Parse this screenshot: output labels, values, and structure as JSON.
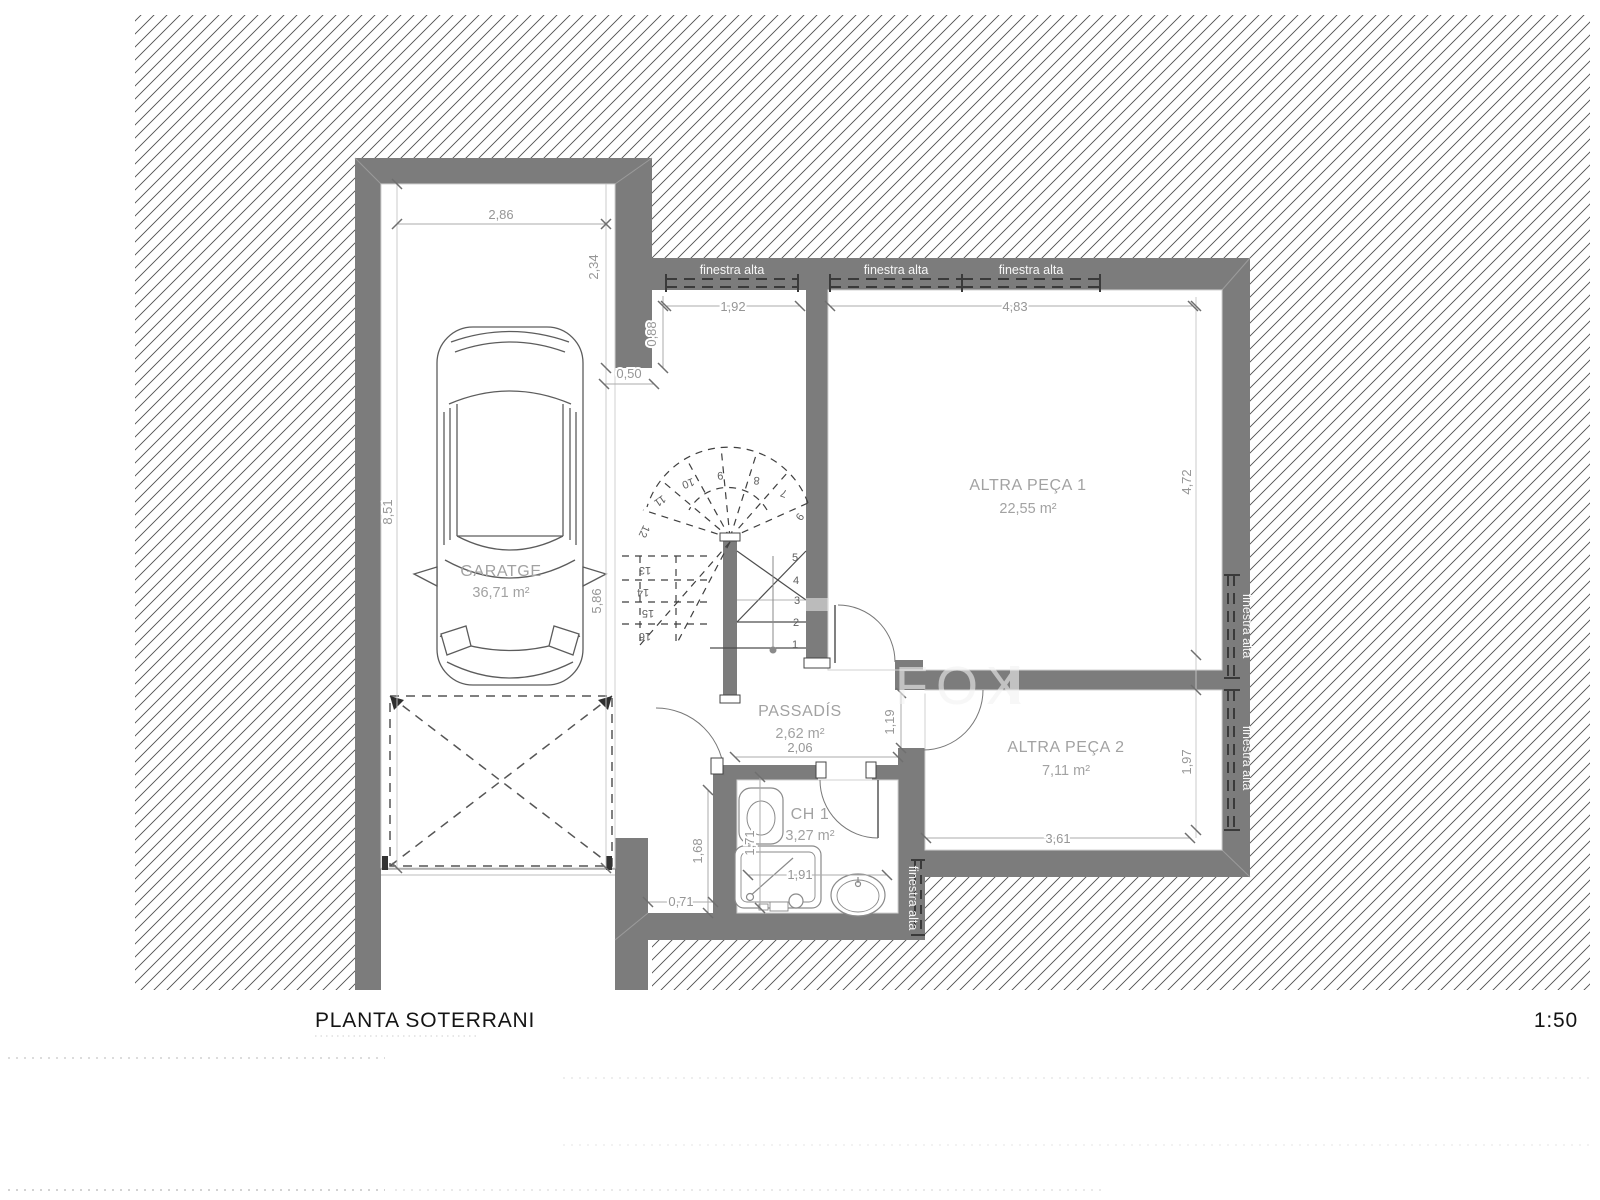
{
  "document": {
    "title": "PLANTA SOTERRANI",
    "scale": "1:50",
    "watermark": "FOX"
  },
  "rooms": {
    "garatge": {
      "name": "GARATGE",
      "area": "36,71 m²"
    },
    "altra_peca_1": {
      "name": "ALTRA PEÇA 1",
      "area": "22,55 m²"
    },
    "altra_peca_2": {
      "name": "ALTRA PEÇA 2",
      "area": "7,11 m²"
    },
    "passadis": {
      "name": "PASSADÍS",
      "area": "2,62 m²"
    },
    "ch1": {
      "name": "CH 1",
      "area": "3,27 m²"
    }
  },
  "window_label": "finestra alta",
  "dimensions": {
    "garage_width": "2,86",
    "garage_return": "2,34",
    "setback": "0,50",
    "window1_offset": "0,88",
    "window1_width": "1,92",
    "top_span": "4,83",
    "garage_length": "8,51",
    "stair_bay": "5,86",
    "room1_depth": "4,72",
    "door_opening": "1,19",
    "corridor_span": "2,06",
    "room2_width": "3,61",
    "room2_depth": "1,97",
    "nook_depth": "1,68",
    "bath_depth": "1,71",
    "bath_width": "1,91",
    "nook_width": "0,71"
  },
  "stairs": {
    "steps": [
      "1",
      "2",
      "3",
      "4",
      "5",
      "6",
      "7",
      "8",
      "9",
      "10",
      "11",
      "12",
      "13",
      "14",
      "15",
      "16"
    ]
  },
  "colors": {
    "wall": "#7c7c7c",
    "hatch_line": "#4f4f4f",
    "dim_line": "#ababab",
    "drawing_line": "#5c5c5c"
  }
}
